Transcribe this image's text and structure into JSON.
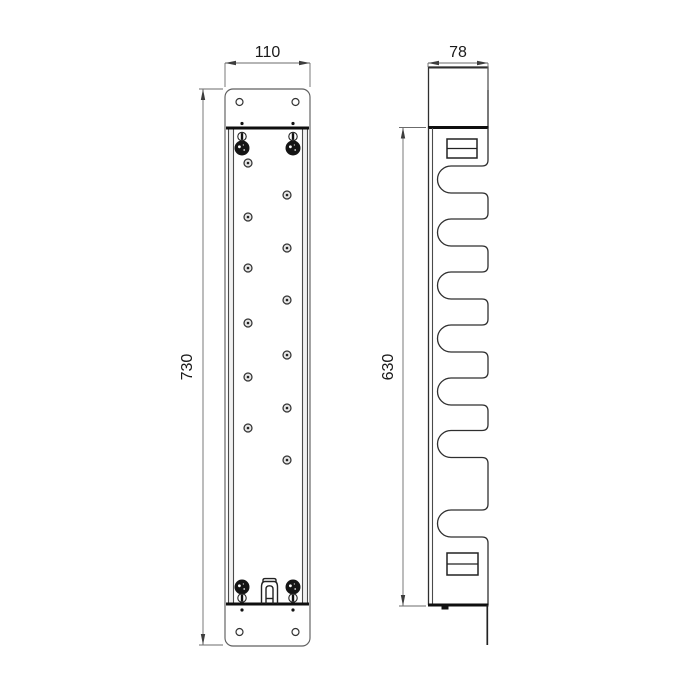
{
  "drawing": {
    "type": "technical-drawing-two-views",
    "colors": {
      "background": "#ffffff",
      "main_line": "#2f2f2f",
      "section_line": "#0f0f0f",
      "dimension_line": "#6b6b6b",
      "text": "#1a1a1a"
    },
    "dimensions": {
      "front_width": {
        "label": "110"
      },
      "side_width": {
        "label": "78"
      },
      "front_height": {
        "label": "730"
      },
      "side_height": {
        "label": "630"
      }
    },
    "front_view": {
      "plate": {
        "x": 225,
        "y": 89,
        "w": 85,
        "h": 557,
        "rx": 8
      },
      "plate_holes": {
        "r": 3.5,
        "points": [
          [
            239.5,
            102
          ],
          [
            295.5,
            102
          ],
          [
            239.5,
            632
          ],
          [
            295.5,
            632
          ]
        ]
      },
      "column": {
        "x1": 226,
        "x2": 309,
        "top": 128,
        "bottom": 604,
        "flanges": [
          [
            228.5,
            233.5
          ],
          [
            302.5,
            307.5
          ]
        ]
      },
      "wall_fixing_holes": {
        "r": 4,
        "points": [
          [
            248,
            163
          ],
          [
            287,
            195
          ],
          [
            248,
            217
          ],
          [
            287,
            248
          ],
          [
            248,
            268
          ],
          [
            287,
            300
          ],
          [
            248,
            323
          ],
          [
            287,
            355
          ],
          [
            248,
            377
          ],
          [
            287,
            408
          ],
          [
            248,
            428
          ],
          [
            287,
            460
          ]
        ]
      },
      "corner_screws": {
        "r": 7.5,
        "points": [
          [
            242,
            148
          ],
          [
            293,
            148
          ],
          [
            242,
            587
          ],
          [
            293,
            587
          ]
        ]
      },
      "slotted_screws": {
        "r": 4.2,
        "points": [
          [
            242,
            136.5
          ],
          [
            293,
            136.5
          ],
          [
            242,
            598
          ],
          [
            293,
            598
          ]
        ]
      },
      "index_dots": {
        "r": 1.6,
        "points": [
          [
            242,
            123.5
          ],
          [
            293,
            123.5
          ],
          [
            242,
            610
          ],
          [
            293,
            610
          ]
        ]
      }
    },
    "side_view": {
      "body": {
        "left": 428.5,
        "left_inner": 432.5,
        "right": 488,
        "top": 67,
        "section_y": 127.5,
        "bottom": 605,
        "plate_bottom": 645
      },
      "hook_slots": {
        "mouth_x": 488,
        "shelf_x": 451,
        "radius": 13.5,
        "mouth_r": 6,
        "centers": [
          179.5,
          232.5,
          285.5,
          338.5,
          391.5,
          444,
          523.5
        ]
      },
      "fixing_slots": [
        {
          "x": 447,
          "y": 139,
          "w": 30,
          "h": 19,
          "divider_y": 148.5
        },
        {
          "x": 447,
          "y": 553,
          "w": 31,
          "h": 22,
          "divider_y": 564
        }
      ],
      "bottom_tab": {
        "x": 441.5,
        "y": 605.5,
        "w": 7,
        "h": 4
      }
    }
  }
}
